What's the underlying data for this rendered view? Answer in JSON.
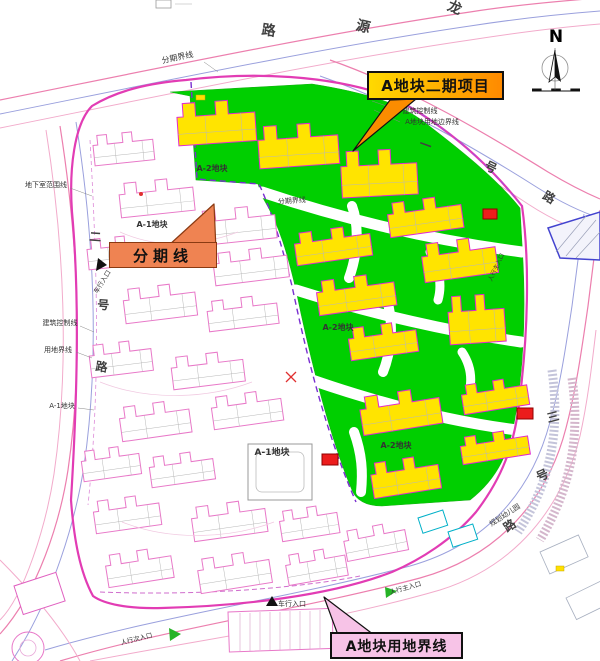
{
  "meta": {
    "title": "A地块二期项目总平面图",
    "width": 600,
    "height": 661
  },
  "colors": {
    "phase2_green": "#00cf00",
    "building_yellow": "#ffe400",
    "building_outline_phase2": "#e02ad0",
    "building_outline_existing": "#e878c8",
    "road_pink": "#ec7fae",
    "road_blue": "#9aa0dd",
    "road_light_pink": "#f2abcb",
    "site_boundary_magenta": "#e23cb4",
    "phase_line_purple": "#7a2fd0",
    "callout_gold_start": "#ffd900",
    "callout_gold_end": "#ff8a00",
    "callout_orange": "#ef8352",
    "callout_pink": "#f7c3e7",
    "marker_red": "#ec1c1c",
    "entrance_green": "#26b326"
  },
  "compass": {
    "label": "N"
  },
  "callouts": [
    {
      "label": "A地块二期项目",
      "bg": "linear-gradient(90deg,#ffd900,#ff8a00)",
      "border": "#111111",
      "arrow": "390,100 416,99 353,151",
      "arrow_fill": "#fb8c00",
      "arrow_stroke": "#111111"
    },
    {
      "label": "分期线",
      "bg": "#ef8352",
      "border": "#8a3a12",
      "arrow": "168,246 216,250 214,204",
      "arrow_fill": "#ef8352",
      "arrow_stroke": "#8a3a12"
    },
    {
      "label": "A地块用地界线",
      "bg": "#f7c3e7",
      "border": "#111111",
      "arrow": "338,635 374,635 324,597",
      "arrow_fill": "#f7c3e7",
      "arrow_stroke": "#111111"
    }
  ],
  "map": {
    "roads": [
      {
        "d": "M0,100 C150,70 320,34 470,12 C515,5 560,1 600,-2",
        "s": "#ec7fae",
        "w": 1.2
      },
      {
        "d": "M0,114 C150,84 320,48 470,26 C515,19 562,14 600,11",
        "s": "#9aa0dd",
        "w": 1
      },
      {
        "d": "M0,128 C150,98 320,62 470,40 C515,33 562,27 600,24",
        "s": "#f2abcb",
        "w": 1
      },
      {
        "d": "M330,60 C410,88 490,136 548,172 C568,184 586,193 600,199",
        "s": "#ec7fae",
        "w": 1.2
      },
      {
        "d": "M320,76 C400,104 478,150 538,188 C562,203 584,213 600,218",
        "s": "#9aa0dd",
        "w": 1
      },
      {
        "d": "M312,92 C392,120 468,164 528,204 C554,221 582,233 600,237",
        "s": "#f2abcb",
        "w": 1
      },
      {
        "d": "M60,126 C78,240 84,360 68,470 C60,522 38,592 0,634",
        "s": "#ec7fae",
        "w": 1.2
      },
      {
        "d": "M46,130 C64,244 70,364 54,474 C46,526 24,596 0,620",
        "s": "#f2abcb",
        "w": 1
      },
      {
        "d": "M76,122 C94,236 100,356 84,466 C76,518 54,596 12,661",
        "s": "#9aa0dd",
        "w": 1
      },
      {
        "d": "M60,661 C170,628 300,610 420,578 C500,556 548,498 566,428 C576,390 582,348 588,306 C592,276 596,240 600,210",
        "s": "#ec7fae",
        "w": 1.2
      },
      {
        "d": "M45,650 C160,616 290,598 410,566 C488,544 532,490 550,422 C560,386 566,346 572,306 C576,276 580,244 584,214",
        "s": "#9aa0dd",
        "w": 1
      },
      {
        "d": "M90,661 C210,638 330,622 440,590 C516,566 562,508 580,436 C588,400 592,364 596,330",
        "s": "#f2abcb",
        "w": 1
      },
      {
        "d": "M0,560 C30,590 60,624 80,661",
        "s": "#f2abcb",
        "w": 1
      }
    ],
    "green": [
      "M170,92 L312,84 C362,92 398,102 424,122 C458,148 496,178 520,208 L522,244 C526,304 524,362 516,412 C510,452 498,478 470,500 L382,506 C366,506 356,500 352,490 C330,438 310,358 296,290 C288,256 280,226 263,198 L258,184 L196,180 L190,96 Z"
    ],
    "green_roads": [
      {
        "d": "M262,192 C340,218 430,240 522,252",
        "w": 11
      },
      {
        "d": "M352,206 C360,228 357,256 349,278",
        "w": 10
      },
      {
        "d": "M296,290 C372,314 452,332 521,342",
        "w": 11
      },
      {
        "d": "M387,300 C394,324 391,352 383,372",
        "w": 10
      },
      {
        "d": "M312,380 C382,404 452,422 517,430",
        "w": 11
      },
      {
        "d": "M354,432 C362,454 363,472 361,492",
        "w": 10
      },
      {
        "d": "M430,252 C440,270 442,286 438,300",
        "w": 9
      },
      {
        "d": "M462,352 C470,364 472,376 470,388",
        "w": 9
      }
    ],
    "boundaries": [
      {
        "d": "M186,80 C250,72 330,74 394,98 C450,128 492,168 522,206 C530,262 528,336 519,404 C514,446 502,478 476,512 C452,540 420,560 392,572 C330,596 240,606 162,608 C128,609 104,604 93,596 C80,572 74,540 71,500 C77,402 80,300 72,212 C69,170 74,124 92,106 C118,90 150,83 186,80 Z",
        "s": "#e23cb4",
        "w": 2.2
      },
      {
        "d": "M191,82 L197,179 L259,184 C272,212 282,246 292,286 C303,338 322,424 356,502",
        "s": "#7a2fd0",
        "w": 1.4,
        "da": "6,4"
      },
      {
        "d": "M394,98 C450,128 492,168 522,206",
        "s": "#b24ad6",
        "w": 1.2,
        "da": "5,3"
      },
      {
        "d": "M90,140 C98,280 100,390 88,505",
        "s": "#dd8ad8",
        "w": 0.8,
        "da": "4,3"
      },
      {
        "d": "M100,592 C200,596 300,588 360,576",
        "s": "#cf6ccc",
        "w": 1,
        "da": "5,3"
      }
    ],
    "buildings": {
      "phase2": [
        [
          176,
          104,
          78,
          42,
          -4
        ],
        [
          257,
          127,
          80,
          42,
          -4
        ],
        [
          340,
          152,
          76,
          46,
          -3
        ],
        [
          386,
          204,
          74,
          34,
          -8
        ],
        [
          293,
          234,
          76,
          32,
          -8
        ],
        [
          420,
          245,
          74,
          38,
          -8
        ],
        [
          315,
          282,
          78,
          34,
          -8
        ],
        [
          447,
          297,
          56,
          48,
          -4
        ],
        [
          347,
          329,
          68,
          32,
          -8
        ],
        [
          358,
          398,
          80,
          38,
          -9
        ],
        [
          460,
          386,
          66,
          29,
          -9
        ],
        [
          459,
          438,
          68,
          27,
          -9
        ],
        [
          369,
          464,
          68,
          35,
          -9
        ]
      ],
      "existing": [
        [
          92,
          136,
          60,
          30,
          -6
        ],
        [
          118,
          184,
          74,
          34,
          -6
        ],
        [
          196,
          212,
          78,
          34,
          -6
        ],
        [
          86,
          240,
          58,
          30,
          -6
        ],
        [
          212,
          254,
          74,
          32,
          -7
        ],
        [
          122,
          290,
          72,
          34,
          -7
        ],
        [
          206,
          302,
          70,
          30,
          -7
        ],
        [
          88,
          346,
          62,
          32,
          -7
        ],
        [
          170,
          358,
          72,
          32,
          -7
        ],
        [
          118,
          408,
          70,
          34,
          -8
        ],
        [
          210,
          398,
          70,
          32,
          -8
        ],
        [
          80,
          452,
          58,
          30,
          -8
        ],
        [
          148,
          458,
          64,
          30,
          -8
        ],
        [
          92,
          502,
          66,
          32,
          -8
        ],
        [
          190,
          508,
          74,
          34,
          -8
        ],
        [
          278,
          512,
          58,
          30,
          -9
        ],
        [
          104,
          556,
          66,
          32,
          -9
        ],
        [
          196,
          560,
          72,
          34,
          -9
        ],
        [
          284,
          556,
          60,
          30,
          -10
        ],
        [
          342,
          532,
          62,
          30,
          -11
        ]
      ]
    },
    "misc": [
      {
        "t": "poly",
        "p": "548,228 600,212 600,260 560,258",
        "f": "#f3f3fb",
        "s": "#4343cf",
        "sw": 1.5
      },
      {
        "t": "path",
        "d": "M556,252 L586,216 M566,256 L596,220 M576,258 L600,232",
        "s": "#9aa0b8",
        "sw": 0.7
      },
      {
        "t": "rect",
        "x": 483,
        "y": 209,
        "w": 14,
        "h": 10,
        "f": "#ec1c1c",
        "s": "#8f0000",
        "sw": 1
      },
      {
        "t": "rect",
        "x": 517,
        "y": 408,
        "w": 16,
        "h": 11,
        "f": "#ec1c1c",
        "s": "#8f0000",
        "sw": 1
      },
      {
        "t": "rect",
        "x": 322,
        "y": 454,
        "w": 16,
        "h": 11,
        "f": "#ec1c1c",
        "s": "#8f0000",
        "sw": 1
      },
      {
        "t": "path",
        "d": "M286,372 L296,382 M296,372 L286,382",
        "s": "#e03030",
        "sw": 1.3
      },
      {
        "t": "circle",
        "cx": 141,
        "cy": 194,
        "r": 2,
        "f": "#e03030"
      },
      {
        "t": "rect",
        "x": 418,
        "y": 518,
        "w": 26,
        "h": 16,
        "rot": -18,
        "f": "#ffffff",
        "s": "#00b0c8",
        "sw": 1
      },
      {
        "t": "rect",
        "x": 448,
        "y": 532,
        "w": 26,
        "h": 16,
        "rot": -18,
        "f": "#ffffff",
        "s": "#00b0c8",
        "sw": 1
      },
      {
        "t": "rect",
        "x": 228,
        "y": 612,
        "w": 104,
        "h": 40,
        "rot": -2,
        "f": "#ffffff",
        "s": "#e878c8",
        "sw": 1
      },
      {
        "t": "path",
        "d": "M240,613 V651 M250,613 V651 M260,612 V650 M270,612 V650 M280,612 V650 M290,611 V649 M300,611 V649 M310,611 V649 M320,610 V648",
        "s": "#d8a0c8",
        "sw": 0.6
      },
      {
        "t": "rect",
        "x": 248,
        "y": 444,
        "w": 64,
        "h": 56,
        "f": "none",
        "s": "#999999",
        "sw": 1
      },
      {
        "t": "rect",
        "x": 256,
        "y": 452,
        "w": 48,
        "h": 40,
        "rx": 6,
        "f": "none",
        "s": "#bbbbbb",
        "sw": 0.8
      },
      {
        "t": "circle",
        "cx": 28,
        "cy": 648,
        "r": 16,
        "f": "none",
        "s": "#e878c8",
        "sw": 1
      },
      {
        "t": "circle",
        "cx": 28,
        "cy": 648,
        "r": 8,
        "f": "none",
        "s": "#e8a8d8",
        "sw": 0.8
      },
      {
        "t": "rect",
        "x": 14,
        "y": 586,
        "w": 44,
        "h": 30,
        "rot": -18,
        "f": "#ffffff",
        "s": "#e060c0",
        "sw": 1
      },
      {
        "t": "rect",
        "x": 540,
        "y": 552,
        "w": 42,
        "h": 24,
        "rot": -24,
        "f": "#ffffff",
        "s": "#a8b0c0",
        "sw": 0.8
      },
      {
        "t": "rect",
        "x": 566,
        "y": 598,
        "w": 42,
        "h": 24,
        "rot": -26,
        "f": "#ffffff",
        "s": "#a8b0c0",
        "sw": 0.8
      },
      {
        "t": "path",
        "d": "M552,370 C560,430 552,480 518,532",
        "s": "#c4c4da",
        "sw": 9,
        "da": "2,2"
      },
      {
        "t": "path",
        "d": "M572,378 C580,436 572,486 540,540",
        "s": "#d4b6cc",
        "sw": 9,
        "da": "2,2"
      },
      {
        "t": "line",
        "x1": 532,
        "y1": 91,
        "x2": 580,
        "y2": 91,
        "s": "#111111",
        "sw": 1
      },
      {
        "t": "rect",
        "x": 532,
        "y": 88.5,
        "w": 9.6,
        "h": 2.5,
        "f": "#111111"
      },
      {
        "t": "rect",
        "x": 551.2,
        "y": 88.5,
        "w": 9.6,
        "h": 2.5,
        "f": "#111111"
      },
      {
        "t": "rect",
        "x": 570.4,
        "y": 88.5,
        "w": 9.6,
        "h": 2.5,
        "f": "#111111"
      },
      {
        "t": "circle",
        "cx": 555,
        "cy": 68,
        "r": 13,
        "f": "none",
        "s": "#909090",
        "sw": 0.8
      },
      {
        "t": "line",
        "x1": 555,
        "y1": 48,
        "x2": 555,
        "y2": 90,
        "s": "#555555",
        "sw": 0.6
      },
      {
        "t": "poly",
        "p": "555,50 561,82 555,77",
        "f": "#111111"
      },
      {
        "t": "poly",
        "p": "555,50 549,82 555,77",
        "f": "#ffffff",
        "s": "#111111",
        "sw": 0.8
      },
      {
        "t": "rect",
        "x": 156,
        "y": 0,
        "w": 15,
        "h": 8,
        "f": "none",
        "s": "#999999",
        "sw": 0.8
      },
      {
        "t": "line",
        "x1": 175,
        "y1": 4,
        "x2": 192,
        "y2": 4,
        "s": "#aaaaaa",
        "sw": 0.6
      },
      {
        "t": "poly",
        "p": "98,258 107,265 96,271",
        "f": "#111111"
      },
      {
        "t": "poly",
        "p": "266,606 278,606 272,596",
        "f": "#111111"
      },
      {
        "t": "poly",
        "p": "169,628 181,634 170,641",
        "f": "#26b326"
      },
      {
        "t": "poly",
        "p": "385,587 397,591 386,598",
        "f": "#26b326"
      },
      {
        "t": "rect",
        "x": 196,
        "y": 95,
        "w": 9,
        "h": 5,
        "f": "#ffe000",
        "s": "#c8a800",
        "sw": 0.5
      },
      {
        "t": "rect",
        "x": 556,
        "y": 566,
        "w": 8,
        "h": 5,
        "f": "#ffe000",
        "s": "#c8a800",
        "sw": 0.5
      },
      {
        "t": "path",
        "d": "M120,232 C160,250 200,246 238,232",
        "s": "#f0c8e0",
        "sw": 0.7
      },
      {
        "t": "path",
        "d": "M100,382 C150,402 210,398 252,382",
        "s": "#f0c8e0",
        "sw": 0.7
      },
      {
        "t": "path",
        "d": "M122,522 C172,542 232,538 274,522",
        "s": "#f0c8e0",
        "sw": 0.7
      },
      {
        "t": "line",
        "x1": 70,
        "y1": 188,
        "x2": 92,
        "y2": 196,
        "s": "#888888",
        "sw": 0.5
      },
      {
        "t": "line",
        "x1": 80,
        "y1": 326,
        "x2": 94,
        "y2": 332,
        "s": "#888888",
        "sw": 0.5
      },
      {
        "t": "line",
        "x1": 76,
        "y1": 352,
        "x2": 92,
        "y2": 358,
        "s": "#888888",
        "sw": 0.5
      },
      {
        "t": "line",
        "x1": 78,
        "y1": 408,
        "x2": 94,
        "y2": 410,
        "s": "#888888",
        "sw": 0.5
      },
      {
        "t": "line",
        "x1": 398,
        "y1": 110,
        "x2": 372,
        "y2": 101,
        "s": "#888888",
        "sw": 0.5
      },
      {
        "t": "line",
        "x1": 400,
        "y1": 122,
        "x2": 374,
        "y2": 110,
        "s": "#888888",
        "sw": 0.5
      },
      {
        "t": "line",
        "x1": 204,
        "y1": 62,
        "x2": 218,
        "y2": 72,
        "s": "#888888",
        "sw": 0.5
      }
    ],
    "labels": [
      {
        "t": "N",
        "x": 556,
        "y": 42,
        "s": 17,
        "r": 0,
        "b": 1,
        "c": "#000000"
      },
      {
        "t": "龙",
        "x": 453,
        "y": 12,
        "s": 14,
        "r": 22,
        "b": 1,
        "c": "#404040"
      },
      {
        "t": "源",
        "x": 362,
        "y": 31,
        "s": 14,
        "r": 14,
        "b": 1,
        "c": "#404040"
      },
      {
        "t": "路",
        "x": 268,
        "y": 35,
        "s": 14,
        "r": 8,
        "b": 1,
        "c": "#404040"
      },
      {
        "t": "一",
        "x": 424,
        "y": 149,
        "s": 12,
        "r": 20,
        "b": 1,
        "c": "#404040"
      },
      {
        "t": "号",
        "x": 489,
        "y": 171,
        "s": 12,
        "r": 26,
        "b": 1,
        "c": "#404040"
      },
      {
        "t": "路",
        "x": 547,
        "y": 201,
        "s": 12,
        "r": 30,
        "b": 1,
        "c": "#404040"
      },
      {
        "t": "二",
        "x": 95,
        "y": 241,
        "s": 12,
        "r": 4,
        "b": 1,
        "c": "#404040"
      },
      {
        "t": "号",
        "x": 103,
        "y": 309,
        "s": 12,
        "r": 4,
        "b": 1,
        "c": "#404040"
      },
      {
        "t": "路",
        "x": 101,
        "y": 371,
        "s": 12,
        "r": 8,
        "b": 1,
        "c": "#404040"
      },
      {
        "t": "三",
        "x": 554,
        "y": 421,
        "s": 12,
        "r": -14,
        "b": 1,
        "c": "#404040"
      },
      {
        "t": "号",
        "x": 544,
        "y": 479,
        "s": 12,
        "r": -24,
        "b": 1,
        "c": "#404040"
      },
      {
        "t": "路",
        "x": 512,
        "y": 529,
        "s": 12,
        "r": -34,
        "b": 1,
        "c": "#404040"
      },
      {
        "t": "分期界线",
        "x": 178,
        "y": 60,
        "s": 8,
        "r": -12
      },
      {
        "t": "建筑控制线",
        "x": 420,
        "y": 113,
        "s": 7
      },
      {
        "t": "A地块用地边界线",
        "x": 432,
        "y": 124,
        "s": 7
      },
      {
        "t": "分期界线",
        "x": 292,
        "y": 203,
        "s": 7,
        "r": -4
      },
      {
        "t": "A-2地块",
        "x": 212,
        "y": 171,
        "s": 8,
        "b": 1
      },
      {
        "t": "A-1地块",
        "x": 152,
        "y": 227,
        "s": 8,
        "b": 1
      },
      {
        "t": "A-2地块",
        "x": 338,
        "y": 330,
        "s": 8,
        "b": 1
      },
      {
        "t": "A-2地块",
        "x": 396,
        "y": 448,
        "s": 8,
        "b": 1
      },
      {
        "t": "A-1地块",
        "x": 272,
        "y": 455,
        "s": 9,
        "b": 1
      },
      {
        "t": "地下室范围线",
        "x": 46,
        "y": 187,
        "s": 7
      },
      {
        "t": "建筑控制线",
        "x": 60,
        "y": 325,
        "s": 7
      },
      {
        "t": "用地界线",
        "x": 58,
        "y": 352,
        "s": 7
      },
      {
        "t": "A-1地块",
        "x": 62,
        "y": 408,
        "s": 7
      },
      {
        "t": "规划幼儿园",
        "x": 506,
        "y": 517,
        "s": 7,
        "r": -33
      },
      {
        "t": "人行主入口",
        "x": 498,
        "y": 268,
        "s": 6,
        "r": -65
      },
      {
        "t": "车行入口",
        "x": 104,
        "y": 283,
        "s": 6.5,
        "r": -58
      },
      {
        "t": "车行入口",
        "x": 292,
        "y": 606,
        "s": 7
      },
      {
        "t": "人行次入口",
        "x": 137,
        "y": 641,
        "s": 6.5,
        "r": -14
      },
      {
        "t": "人行主入口",
        "x": 406,
        "y": 590,
        "s": 6.5,
        "r": -16
      }
    ]
  }
}
